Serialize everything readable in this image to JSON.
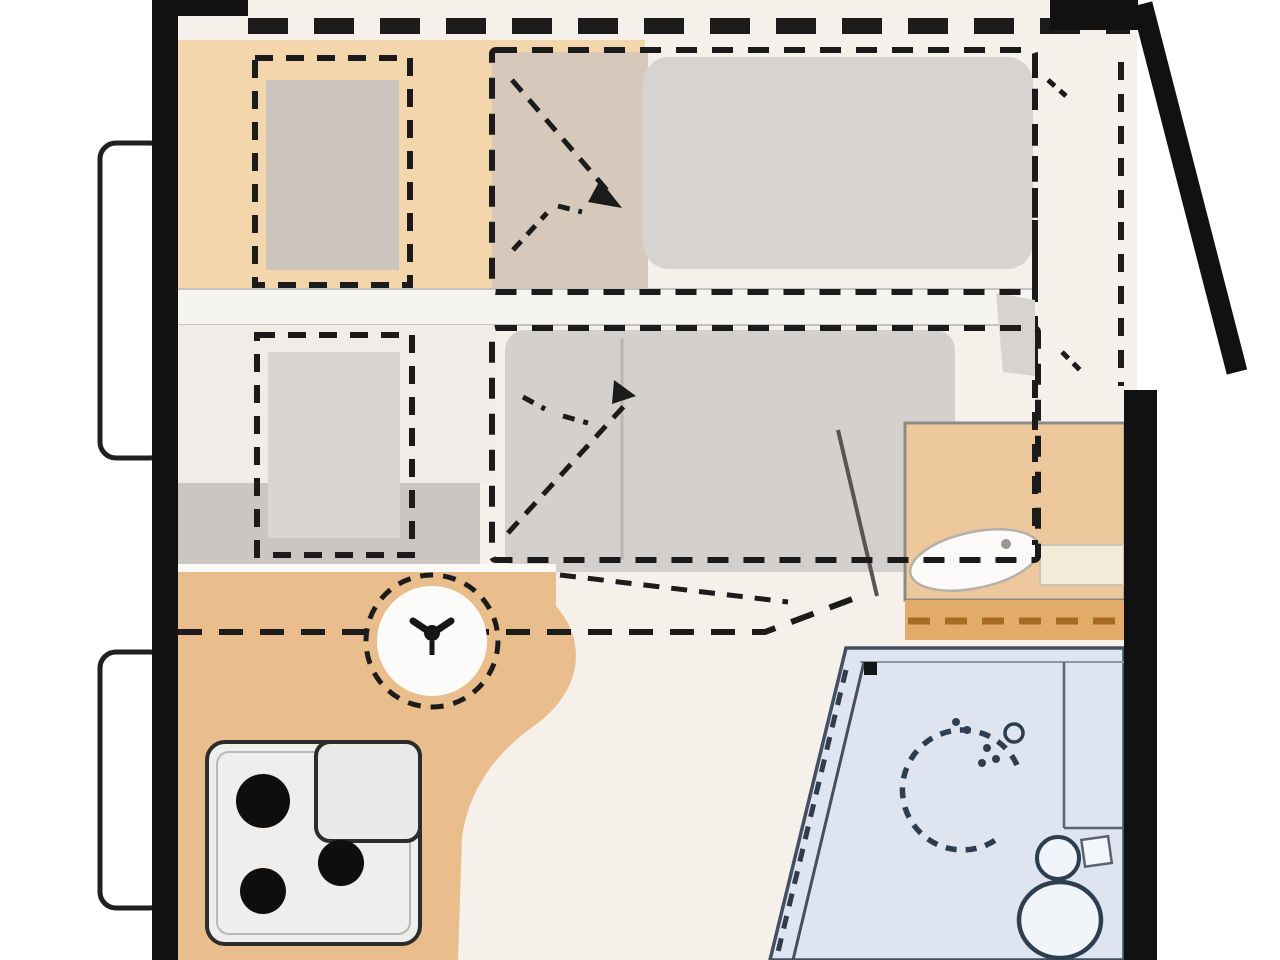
{
  "diagram": {
    "kind": "caravan-floor-plan-top-view",
    "rooms": [
      {
        "name": "front-dinette",
        "description": "orange bench seating with table, converts to bed (dashed outline)"
      },
      {
        "name": "middle-lounge",
        "description": "second seating/bed area with table and fold-out bed (dashed outline)"
      },
      {
        "name": "kitchen",
        "description": "orange counter with round sink and 3-burner stove"
      },
      {
        "name": "washroom",
        "description": "blue-floor bathroom with shower, washbasin cabinet and toilet"
      },
      {
        "name": "entrance",
        "description": "open entry door on right wall shown swung outward"
      }
    ],
    "fixtures": [
      "drop-down-bed-dashed-outline",
      "front-bed-mattress",
      "middle-bed-mattress",
      "dinette-table-front",
      "dinette-table-middle",
      "fold-direction-arrows",
      "round-sink-with-faucet",
      "stove-three-burners",
      "washbasin-cabinet",
      "shower-dashed-ring-with-head",
      "toilet",
      "entry-door-open-leaf",
      "side-window-front",
      "side-window-rear"
    ]
  },
  "palette": {
    "page_white": "#ffffff",
    "wall_black": "#111111",
    "floor_cream": "#f5f1ea",
    "dinette_orange": "#f3d6ac",
    "kitchen_orange": "#eabe8c",
    "cabinet_orange": "#ecc89c",
    "cabinet_strip_orange": "#e3ab69",
    "fold_cell_tan": "#d6c9bc",
    "mattress_gray": "#d6d3d0",
    "mattress_gray_mid": "#d3d0cd",
    "band_gray": "#cac7c3",
    "cream_block": "#f0ede9",
    "white_band": "#f6f4f1",
    "table_fill_front": "#cdc5bd",
    "table_fill_middle": "#d9d6d2",
    "bath_blue": "#dfe5f0",
    "bath_stroke": "#44505f",
    "fixture_white": "#f1f4f9",
    "stove_face": "#efeeec",
    "burner_black": "#0e0e0e",
    "sink_white": "#fbfbf9",
    "dash_black": "#1b1b1b",
    "dash_brown": "#a56b25",
    "outline_gray": "#8b8b86",
    "wedge_gray": "#d7d3cf",
    "shelf_cream": "#f4ead8",
    "window_white": "#ffffff"
  }
}
